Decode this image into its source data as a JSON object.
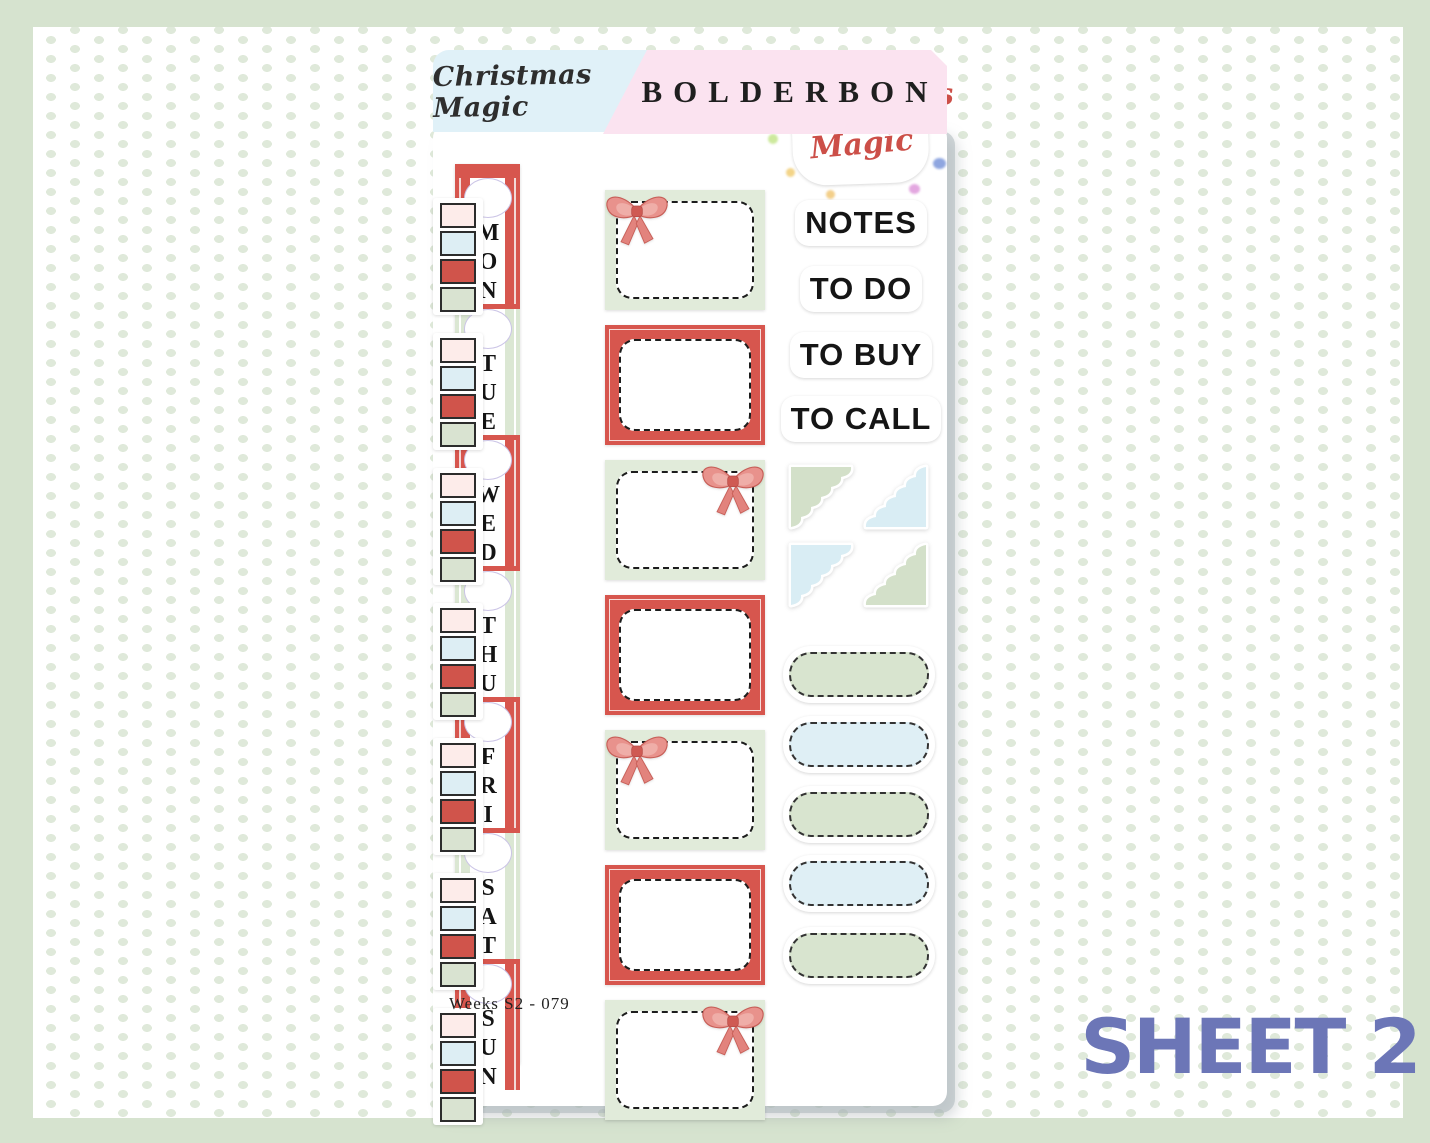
{
  "header": {
    "collection_tab": "Christmas Magic",
    "brand_tab": "BOLDERBON"
  },
  "logo_sticker": {
    "line1": "Christmas",
    "line2": "Magic"
  },
  "phrase_stickers": [
    "NOTES",
    "TO DO",
    "TO BUY",
    "TO CALL"
  ],
  "day_stickers": [
    "MON",
    "TUE",
    "WED",
    "THU",
    "FRI",
    "SAT",
    "SUN"
  ],
  "footer": {
    "sheet_code": "Weeks  S2 - 079"
  },
  "page_label": "SHEET 2",
  "palette": {
    "frame_green": "#d6e3cf",
    "dot_green": "#dfe9da",
    "tab_blue": "#e0f1f8",
    "tab_pink": "#fbe3f0",
    "red": "#d7564e",
    "box_green": "#e1ebda",
    "strip_green": "#dbe7d3",
    "swatch_pink": "#fdecea",
    "swatch_blue": "#ddeef4",
    "swatch_red": "#d0544b",
    "swatch_green": "#d9e3d1",
    "pill_green": "#d8e4cf",
    "pill_blue": "#dfeff5",
    "corner_green": "#d3e0c9",
    "corner_blue": "#d9edf4",
    "logo_red": "#cc4f48",
    "page_label_purple": "#6c76b7"
  },
  "structure": {
    "day_segments": 7,
    "swatch_groups": 7,
    "swatches_per_group": [
      "pink",
      "blue",
      "red",
      "green"
    ],
    "boxes": [
      "green-bow-left",
      "red",
      "green-bow-right",
      "red",
      "green-bow-left",
      "red",
      "green-bow-right"
    ],
    "corner_stickers": [
      "green-top-left",
      "blue-bottom-right",
      "blue-top-left",
      "green-bottom-right"
    ],
    "pills": [
      "green",
      "blue",
      "green",
      "blue",
      "green"
    ]
  }
}
